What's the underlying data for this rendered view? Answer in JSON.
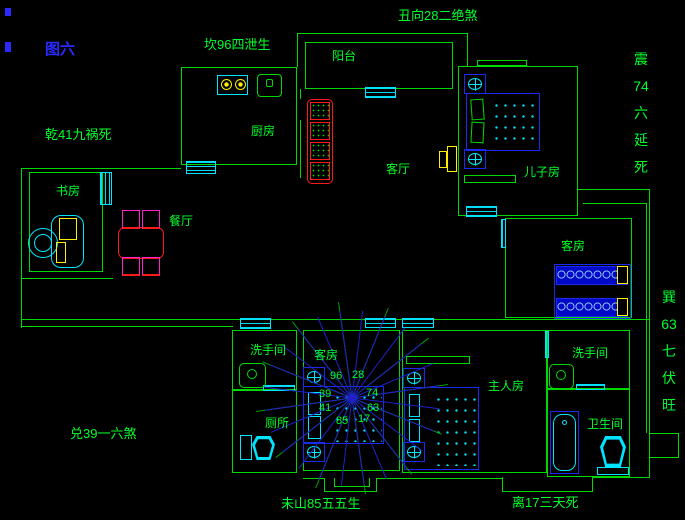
{
  "figure_label": "图六",
  "direction_labels": {
    "top": "丑向28二绝煞",
    "north": "坎96四泄生",
    "northwest": "乾41九祸死",
    "east_vertical": [
      "震",
      "74",
      "六",
      "延",
      "死"
    ],
    "southeast_vertical": [
      "巽",
      "63",
      "七",
      "伏",
      "旺"
    ],
    "west": "兑39一六煞",
    "bottom": "未山85五五生",
    "south": "离17三天死"
  },
  "room_labels": {
    "balcony": "阳台",
    "kitchen": "厨房",
    "living_room": "客厅",
    "son_room": "儿子房",
    "study": "书房",
    "dining_room": "餐厅",
    "guest_room_east": "客房",
    "guest_room_center": "客房",
    "washroom_west": "洗手间",
    "toilet_west": "厕所",
    "master_room": "主人房",
    "washroom_east": "洗手间",
    "bathroom_east": "卫生间"
  },
  "compass": {
    "numbers": [
      "96",
      "28",
      "74",
      "63",
      "17",
      "85",
      "41",
      "39"
    ],
    "blue_rays": 24,
    "green_rays": 12,
    "blue_radius": 88,
    "green_radius": 97,
    "blue_offset_deg": 7,
    "green_offset_deg": 22,
    "blue_color": "#2020cc",
    "green_color": "#00a000"
  },
  "colors": {
    "background": "#000000",
    "wall_green": "#00d900",
    "text_green": "#00ff2a",
    "window_cyan": "#00e5ff",
    "furniture_blue": "#1b2bee",
    "accent_red": "#ff1a1a",
    "accent_magenta": "#ff22cc",
    "accent_yellow": "#ffee00",
    "figure_label_blue": "#2a2aff"
  }
}
